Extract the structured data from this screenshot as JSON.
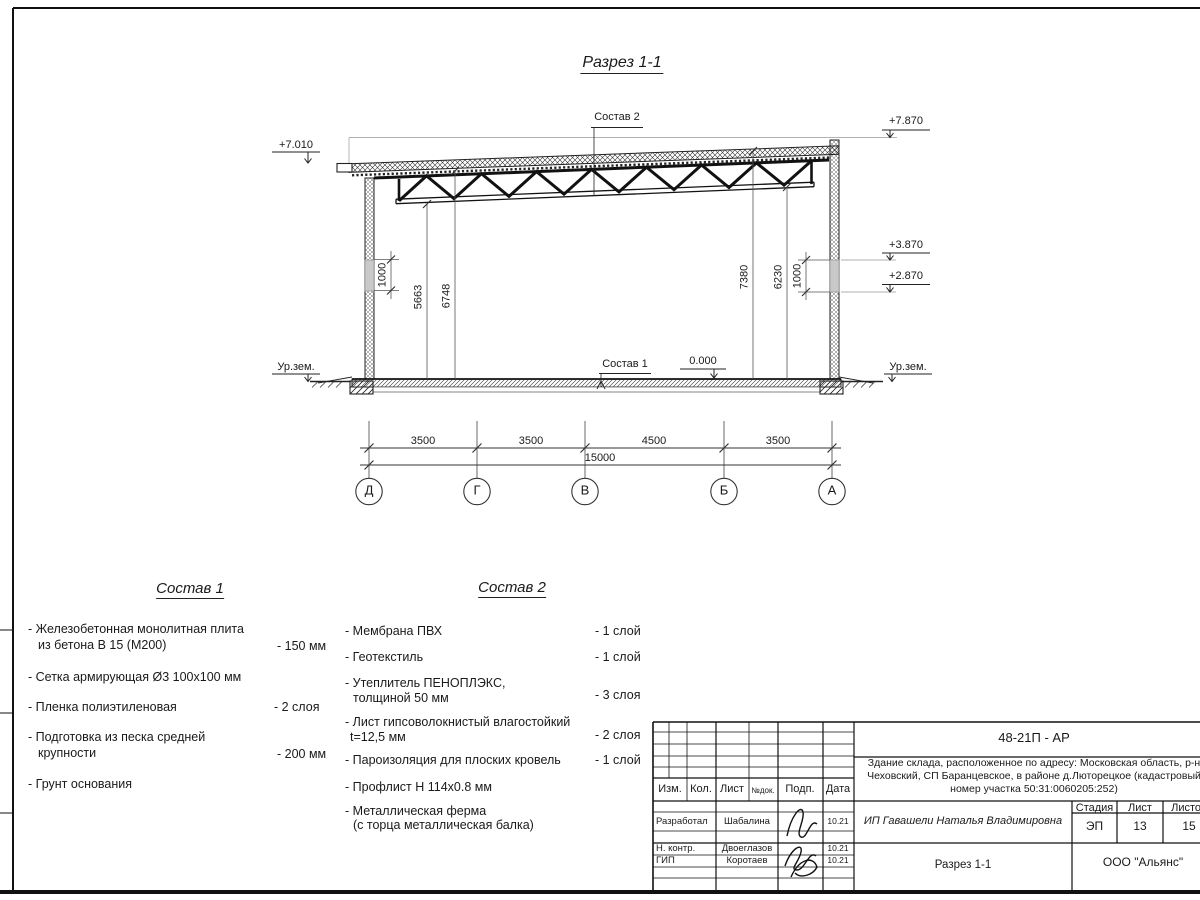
{
  "drawing_title": "Разрез 1-1",
  "section": {
    "sostav2_label": "Состав 2",
    "sostav1_label": "Состав 1",
    "elevations": {
      "left_top": "+7.010",
      "right_top": "+7.870",
      "right_window_top": "+3.870",
      "right_window_bottom": "+2.870",
      "zero": "0.000",
      "ground_left": "Ур.зем.",
      "ground_right": "Ур.зем."
    },
    "vertical_dims": {
      "left_window": "1000",
      "left_to_bottom_chord": "5663",
      "left_to_top_chord": "6748",
      "right_to_top_chord": "7380",
      "right_to_bottom_chord": "6230",
      "right_window": "1000"
    },
    "horizontal_dims": [
      "3500",
      "3500",
      "4500",
      "3500"
    ],
    "total_dim": "15000",
    "axes": [
      "Д",
      "Г",
      "В",
      "Б",
      "А"
    ]
  },
  "sostav1": {
    "title": "Состав 1",
    "items": [
      {
        "line1": "- Железобетонная  монолитная плита",
        "line2": "из бетона В 15 (М200)",
        "value": "- 150 мм"
      },
      {
        "line1": "- Сетка армирующая Ø3 100х100 мм",
        "line2": "",
        "value": ""
      },
      {
        "line1": "- Пленка полиэтиленовая",
        "line2": "",
        "value": "-  2 слоя"
      },
      {
        "line1": "- Подготовка из песка средней",
        "line2": "крупности",
        "value": "- 200 мм"
      },
      {
        "line1": "- Грунт основания",
        "line2": "",
        "value": ""
      }
    ]
  },
  "sostav2": {
    "title": "Состав 2",
    "items": [
      {
        "line1": "- Мембрана ПВХ",
        "line2": "",
        "value": "- 1 слой"
      },
      {
        "line1": "- Геотекстиль",
        "line2": "",
        "value": "- 1 слой"
      },
      {
        "line1": "- Утеплитель ПЕНОПЛЭКС,",
        "line2": "толщиной 50 мм",
        "value": "- 3 слоя"
      },
      {
        "line1": "- Лист гипсоволокнистый влагостойкий",
        "line2": "t=12,5 мм",
        "value": "- 2 слоя"
      },
      {
        "line1": "- Пароизоляция для плоских кровель",
        "line2": "",
        "value": "- 1 слой"
      },
      {
        "line1": "- Профлист Н 114х0.8 мм",
        "line2": "",
        "value": ""
      },
      {
        "line1": "- Металлическая ферма",
        "line2": "(с торца металлическая балка)",
        "value": ""
      }
    ]
  },
  "titleblock": {
    "doc_code": "48-21П - АР",
    "description_line1": "Здание склада, расположенное по адресу: Московская область, р-н",
    "description_line2": "Чеховский, СП Баранцевское, в районе д.Люторецкое  (кадастровый",
    "description_line3": "номер участка 50:31:0060205:252)",
    "columns": {
      "izm": "Изм.",
      "kol": "Кол.",
      "list": "Лист",
      "ndok": "№док.",
      "podp": "Подп.",
      "data": "Дата"
    },
    "rows": [
      {
        "role": "Разработал",
        "name": "Шабалина",
        "date": "10.21"
      },
      {
        "role": "Н. контр.",
        "name": "Двоеглазов",
        "date": "10.21"
      },
      {
        "role": "ГИП",
        "name": "Коротаев",
        "date": "10.21"
      }
    ],
    "client": "ИП Гавашели Наталья Владимировна",
    "stage_label": "Стадия",
    "sheet_label": "Лист",
    "sheets_label": "Листов",
    "stage": "ЭП",
    "sheet": "13",
    "sheets": "15",
    "sheet_title": "Разрез 1-1",
    "company": "ООО \"Альянс\""
  }
}
